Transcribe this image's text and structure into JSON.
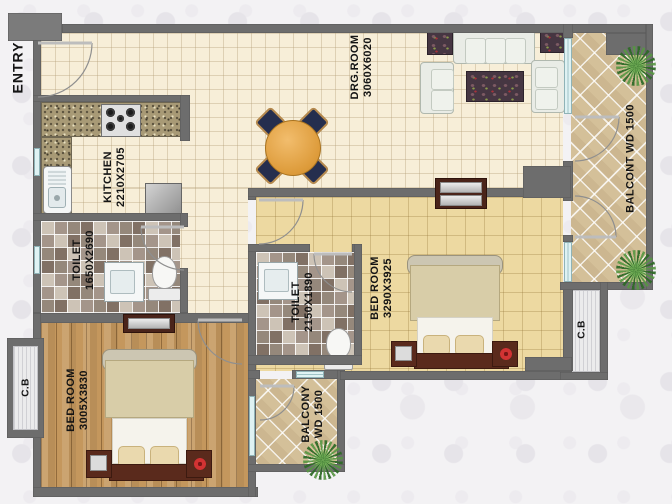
{
  "rooms": {
    "entry": {
      "label": "ENTRY"
    },
    "kitchen": {
      "label": "KITCHEN",
      "dims": "2210X2705"
    },
    "drg_room": {
      "label": "DRG.ROOM",
      "dims": "3060X6020"
    },
    "toilet_top": {
      "label": "TOILET",
      "dims": "1650X2690"
    },
    "toilet_mid": {
      "label": "TOILET",
      "dims": "2150X1890"
    },
    "bedroom_right": {
      "label": "BED ROOM",
      "dims": "3290X3925"
    },
    "bedroom_left": {
      "label": "BED ROOM",
      "dims": "3005X3830"
    },
    "balcony_right": {
      "label": "BALCONT WD 1500"
    },
    "balcony_bottom": {
      "label": "BALCONY",
      "dims": "WD 1500"
    },
    "cupboard_left": {
      "label": "C.B"
    },
    "cupboard_right": {
      "label": "C.B"
    }
  },
  "fixtures": [
    "gas-stove",
    "kitchen-sink",
    "refrigerator",
    "wash-basin",
    "toilet-wc",
    "dining-table",
    "dining-chair",
    "three-seat-sofa",
    "two-seat-sofa",
    "end-table",
    "rug",
    "double-bed",
    "nightstand",
    "table-lamp",
    "flower-pot",
    "wardrobe-cabinet",
    "plant",
    "window",
    "door-swing"
  ],
  "colors": {
    "wall": "#6d6d6d",
    "floor_cream": "#f7eed8",
    "floor_khaki": "#edd9a1",
    "floor_wood": "#c4975d",
    "balcony_tile": "#d4c099",
    "toilet_tile": "#bdb2a4",
    "window_glass": "#dff2f3",
    "dining_table": "#dd9b3a",
    "dining_chair": "#252e4e",
    "bed_frame": "#5a2a1c",
    "flower_accent": "#d23333",
    "plant_green": "#3e7d33"
  }
}
